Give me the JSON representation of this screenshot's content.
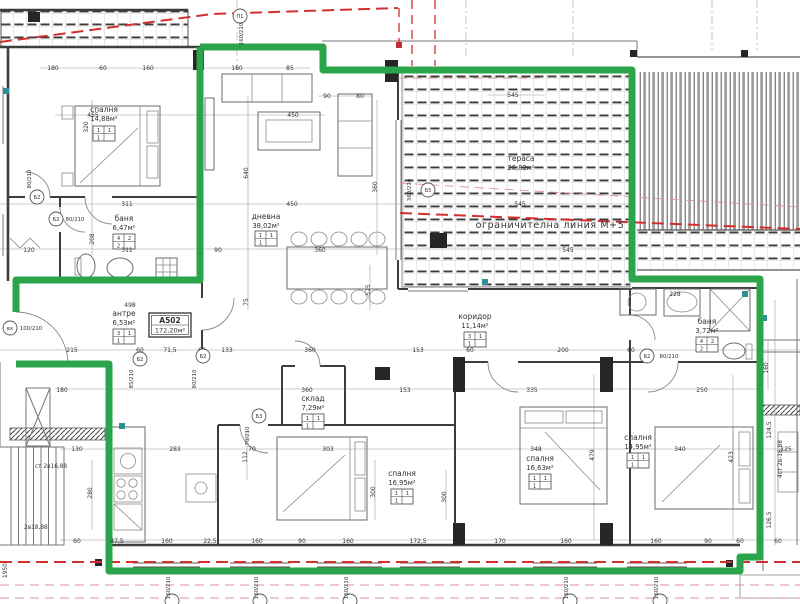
{
  "plan": {
    "apartment_id": "А502",
    "apartment_area": "172,20м²",
    "restriction_line_label": "ограничителна линия М+5",
    "colors": {
      "boundary_green": "#2ca44b",
      "restriction_red": "#d03030",
      "restriction_pink": "#e39191",
      "wall_dark": "#3d3d3d",
      "fixture_teal": "#2e8f96"
    },
    "rooms": [
      {
        "name": "спалня",
        "area": "14,88м²",
        "x": 104,
        "y": 112,
        "by": 126,
        "s": [
          "1",
          "1",
          "1"
        ]
      },
      {
        "name": "баня",
        "area": "6,47м²",
        "x": 124,
        "y": 221,
        "by": 234,
        "s": [
          "4",
          "2",
          "2"
        ]
      },
      {
        "name": "дневна",
        "area": "38,02м²",
        "x": 266,
        "y": 219,
        "by": 231,
        "s": [
          "1",
          "1",
          "1"
        ]
      },
      {
        "name": "тераса",
        "area": "26,82м²",
        "x": 521,
        "y": 161,
        "by": null,
        "s": null
      },
      {
        "name": "антре",
        "area": "6,53м²",
        "x": 124,
        "y": 316,
        "by": 329,
        "s": [
          "3",
          "1",
          "1"
        ]
      },
      {
        "name": "склад",
        "area": "7,29м²",
        "x": 313,
        "y": 401,
        "by": 414,
        "s": [
          "1",
          "1",
          "1"
        ]
      },
      {
        "name": "коридор",
        "area": "11,14м²",
        "x": 475,
        "y": 319,
        "by": 332,
        "s": [
          "3",
          "1",
          "1"
        ]
      },
      {
        "name": "баня",
        "area": "3,72м²",
        "x": 707,
        "y": 324,
        "by": 337,
        "s": [
          "4",
          "2",
          "2"
        ]
      },
      {
        "name": "спалня",
        "area": "16,95м²",
        "x": 402,
        "y": 476,
        "by": 489,
        "s": [
          "1",
          "1",
          "1"
        ]
      },
      {
        "name": "спалня",
        "area": "16,63м²",
        "x": 540,
        "y": 461,
        "by": 474,
        "s": [
          "1",
          "1",
          "1"
        ]
      },
      {
        "name": "спалня",
        "area": "14,95м²",
        "x": 638,
        "y": 440,
        "by": 453,
        "s": [
          "1",
          "1",
          "1"
        ]
      }
    ],
    "dimensions": [
      {
        "t": "180",
        "x": 53,
        "y": 70
      },
      {
        "t": "60",
        "x": 103,
        "y": 70
      },
      {
        "t": "160",
        "x": 148,
        "y": 70
      },
      {
        "t": "160",
        "x": 237,
        "y": 70
      },
      {
        "t": "85",
        "x": 290,
        "y": 70
      },
      {
        "t": "90",
        "x": 327,
        "y": 98
      },
      {
        "t": "80",
        "x": 360,
        "y": 98
      },
      {
        "t": "545",
        "x": 513,
        "y": 97
      },
      {
        "t": "455",
        "x": 93,
        "y": 117
      },
      {
        "t": "450",
        "x": 293,
        "y": 117
      },
      {
        "t": "311",
        "x": 127,
        "y": 206
      },
      {
        "t": "450",
        "x": 292,
        "y": 206
      },
      {
        "t": "545",
        "x": 520,
        "y": 206
      },
      {
        "t": "120",
        "x": 29,
        "y": 252
      },
      {
        "t": "311",
        "x": 127,
        "y": 252
      },
      {
        "t": "90",
        "x": 218,
        "y": 252
      },
      {
        "t": "360",
        "x": 320,
        "y": 252
      },
      {
        "t": "545",
        "x": 568,
        "y": 252
      },
      {
        "t": "228",
        "x": 675,
        "y": 296
      },
      {
        "t": "498",
        "x": 130,
        "y": 307
      },
      {
        "t": "215",
        "x": 72,
        "y": 352
      },
      {
        "t": "60",
        "x": 140,
        "y": 352
      },
      {
        "t": "71,5",
        "x": 170,
        "y": 352
      },
      {
        "t": "60",
        "x": 202,
        "y": 352
      },
      {
        "t": "133",
        "x": 227,
        "y": 352
      },
      {
        "t": "360",
        "x": 310,
        "y": 352
      },
      {
        "t": "153",
        "x": 418,
        "y": 352
      },
      {
        "t": "60",
        "x": 470,
        "y": 352
      },
      {
        "t": "200",
        "x": 563,
        "y": 352
      },
      {
        "t": "60",
        "x": 631,
        "y": 352
      },
      {
        "t": "180",
        "x": 62,
        "y": 392
      },
      {
        "t": "360",
        "x": 307,
        "y": 392
      },
      {
        "t": "153",
        "x": 405,
        "y": 392
      },
      {
        "t": "335",
        "x": 532,
        "y": 392
      },
      {
        "t": "250",
        "x": 702,
        "y": 392
      },
      {
        "t": "130",
        "x": 77,
        "y": 451
      },
      {
        "t": "283",
        "x": 175,
        "y": 451
      },
      {
        "t": "70",
        "x": 252,
        "y": 451
      },
      {
        "t": "303",
        "x": 328,
        "y": 451
      },
      {
        "t": "348",
        "x": 536,
        "y": 451
      },
      {
        "t": "340",
        "x": 680,
        "y": 451
      },
      {
        "t": "125",
        "x": 786,
        "y": 451
      },
      {
        "t": "60",
        "x": 77,
        "y": 543
      },
      {
        "t": "47,5",
        "x": 117,
        "y": 543
      },
      {
        "t": "160",
        "x": 167,
        "y": 543
      },
      {
        "t": "22,5",
        "x": 210,
        "y": 543
      },
      {
        "t": "160",
        "x": 257,
        "y": 543
      },
      {
        "t": "90",
        "x": 302,
        "y": 543
      },
      {
        "t": "160",
        "x": 348,
        "y": 543
      },
      {
        "t": "172,5",
        "x": 418,
        "y": 543
      },
      {
        "t": "170",
        "x": 500,
        "y": 543
      },
      {
        "t": "160",
        "x": 566,
        "y": 543
      },
      {
        "t": "160",
        "x": 656,
        "y": 543
      },
      {
        "t": "90",
        "x": 708,
        "y": 543
      },
      {
        "t": "60",
        "x": 740,
        "y": 543
      },
      {
        "t": "60",
        "x": 778,
        "y": 543
      },
      {
        "t": "320",
        "x": 88,
        "y": 127,
        "r": 1
      },
      {
        "t": "640",
        "x": 248,
        "y": 173,
        "r": 1
      },
      {
        "t": "360",
        "x": 377,
        "y": 187,
        "r": 1
      },
      {
        "t": "208",
        "x": 94,
        "y": 239,
        "r": 1
      },
      {
        "t": "75",
        "x": 248,
        "y": 302,
        "r": 1
      },
      {
        "t": "525",
        "x": 370,
        "y": 290,
        "r": 1
      },
      {
        "t": "112",
        "x": 247,
        "y": 457,
        "r": 1
      },
      {
        "t": "280",
        "x": 92,
        "y": 493,
        "r": 1
      },
      {
        "t": "300",
        "x": 375,
        "y": 492,
        "r": 1
      },
      {
        "t": "300",
        "x": 446,
        "y": 497,
        "r": 1
      },
      {
        "t": "479",
        "x": 594,
        "y": 455,
        "r": 1
      },
      {
        "t": "423",
        "x": 733,
        "y": 457,
        "r": 1
      },
      {
        "t": "160",
        "x": 768,
        "y": 368,
        "r": 1
      },
      {
        "t": "124,5",
        "x": 771,
        "y": 430,
        "r": 1
      },
      {
        "t": "126,5",
        "x": 771,
        "y": 520,
        "r": 1
      }
    ],
    "door_marks": [
      {
        "c": "вх",
        "cx": 10,
        "cy": 328,
        "t": "100/210",
        "tx": 31,
        "ty": 330
      },
      {
        "c": "Б2",
        "cx": 37,
        "cy": 197,
        "t": "80/210",
        "tx": 31,
        "ty": 179,
        "r": 1
      },
      {
        "c": "Б2",
        "cx": 56,
        "cy": 219,
        "t": "80/210",
        "tx": 75,
        "ty": 221
      },
      {
        "c": "Б2",
        "cx": 140,
        "cy": 359,
        "t": "85/210",
        "tx": 133,
        "ty": 379,
        "r": 1
      },
      {
        "c": "Б2",
        "cx": 203,
        "cy": 356,
        "t": "80/210",
        "tx": 196,
        "ty": 379,
        "r": 1
      },
      {
        "c": "Б3",
        "cx": 259,
        "cy": 416,
        "t": "70/210",
        "tx": 249,
        "ty": 436,
        "r": 1
      },
      {
        "c": "Б2",
        "cx": 647,
        "cy": 356,
        "t": "80/210",
        "tx": 669,
        "ty": 358
      },
      {
        "c": "Б5",
        "cx": 428,
        "cy": 190,
        "t": "360/210",
        "tx": 411,
        "ty": 190,
        "r": 1
      },
      {
        "c": "П1",
        "cx": 240,
        "cy": 16,
        "t": "160/210",
        "tx": 243,
        "ty": 34,
        "r": 1
      },
      {
        "c": "",
        "cx": 172,
        "cy": 601,
        "t": "160/210",
        "tx": 170,
        "ty": 588,
        "r": 1
      },
      {
        "c": "",
        "cx": 260,
        "cy": 601,
        "t": "160/210",
        "tx": 258,
        "ty": 588,
        "r": 1
      },
      {
        "c": "",
        "cx": 350,
        "cy": 601,
        "t": "160/210",
        "tx": 348,
        "ty": 588,
        "r": 1
      },
      {
        "c": "",
        "cx": 570,
        "cy": 601,
        "t": "160/210",
        "tx": 568,
        "ty": 588,
        "r": 1
      },
      {
        "c": "",
        "cx": 660,
        "cy": 601,
        "t": "160/210",
        "tx": 658,
        "ty": 588,
        "r": 1
      }
    ],
    "notes": [
      {
        "t": "ст 2в16,88",
        "x": 35,
        "y": 468
      },
      {
        "t": "2в18,88",
        "x": 24,
        "y": 529
      },
      {
        "t": "4ст 2в-16,88",
        "x": 782,
        "y": 478,
        "r": 1
      },
      {
        "t": "1950",
        "x": 7,
        "y": 578,
        "r": 1
      }
    ]
  }
}
